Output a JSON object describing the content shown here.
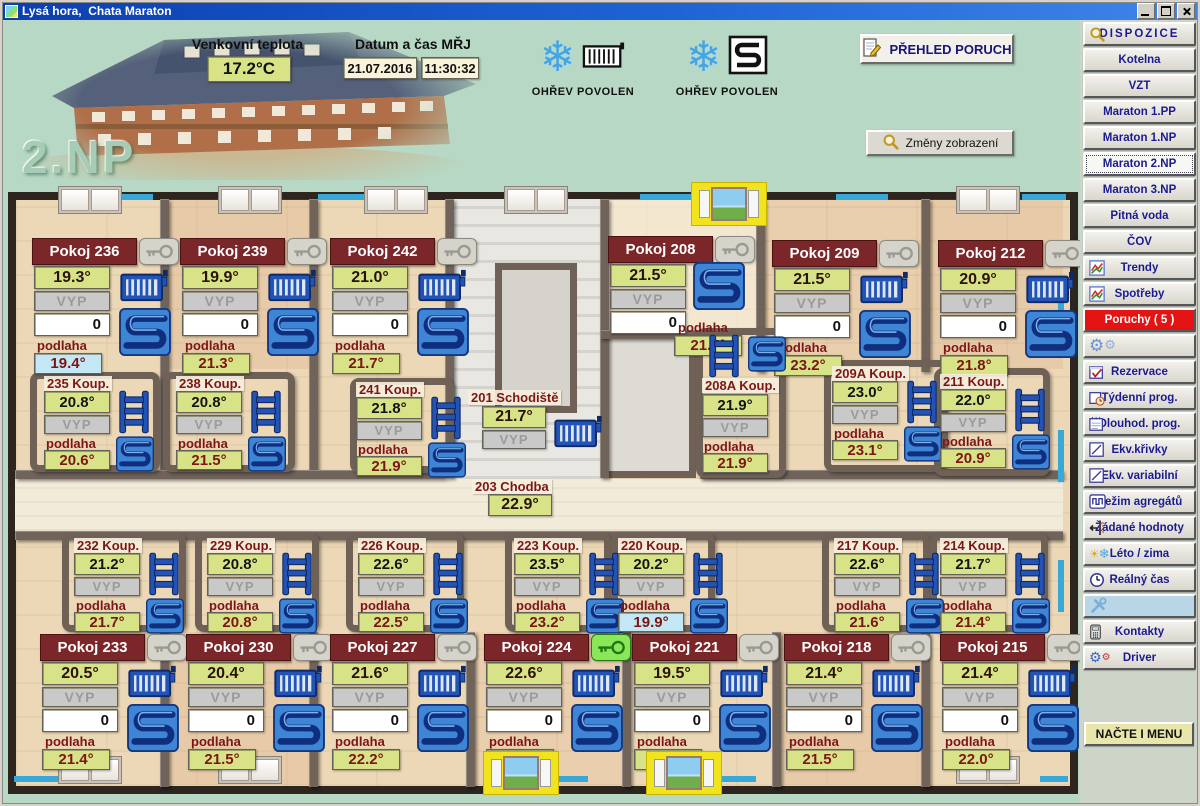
{
  "window": {
    "title": "Lysá hora,  Chata Maraton"
  },
  "header": {
    "floor_label": "2.NP",
    "outdoor": {
      "label": "Venkovní teplota",
      "value": "17.2°C"
    },
    "datetime": {
      "label": "Datum a čas MŘJ",
      "date": "21.07.2016",
      "time": "11:30:32"
    },
    "heat_radiators": {
      "label": "OHŘEV POVOLEN",
      "icons": [
        "snowflake",
        "radiator-outline"
      ]
    },
    "heat_floor": {
      "label": "OHŘEV POVOLEN",
      "icons": [
        "snowflake",
        "floor-coil-outline"
      ]
    },
    "faults_button": {
      "label": "PŘEHLED PORUCH",
      "icon": "report"
    },
    "view_button": {
      "label": "Změny zobrazení",
      "icon": "magnifier"
    }
  },
  "sidebar": {
    "items": [
      {
        "id": "dispozice",
        "label": "DISPOZICE",
        "icon": "magnifier",
        "spaced": true
      },
      {
        "id": "kotelna",
        "label": "Kotelna"
      },
      {
        "id": "vzt",
        "label": "VZT"
      },
      {
        "id": "maraton-1pp",
        "label": "Maraton 1.PP"
      },
      {
        "id": "maraton-1np",
        "label": "Maraton 1.NP"
      },
      {
        "id": "maraton-2np",
        "label": "Maraton 2.NP",
        "active": true
      },
      {
        "id": "maraton-3np",
        "label": "Maraton 3.NP"
      },
      {
        "id": "pitna-voda",
        "label": "Pitná voda"
      },
      {
        "id": "cov",
        "label": "ČOV"
      },
      {
        "id": "trendy",
        "label": "Trendy",
        "icon": "chart"
      },
      {
        "id": "spotreby",
        "label": "Spotřeby",
        "icon": "chart"
      },
      {
        "id": "poruchy",
        "label": "Poruchy ( 5 )",
        "alarm": true
      },
      {
        "id": "nastaveni",
        "label": "",
        "icon": "gears"
      },
      {
        "id": "rezervace",
        "label": "Rezervace",
        "icon": "cal-check"
      },
      {
        "id": "tydenni-prog",
        "label": "Týdenní prog.",
        "icon": "cal-clock"
      },
      {
        "id": "dlouhod-prog",
        "label": "Dlouhod. prog.",
        "icon": "cal"
      },
      {
        "id": "ekv-krivky",
        "label": "Ekv.křivky",
        "icon": "curve"
      },
      {
        "id": "ekv-variabilni",
        "label": "Ekv. variabilní",
        "icon": "curve"
      },
      {
        "id": "rezim-agregatu",
        "label": "Režim agregátů",
        "icon": "agregat"
      },
      {
        "id": "zadane-hodnoty",
        "label": "Žádané hodnoty",
        "icon": "slider"
      },
      {
        "id": "leto-zima",
        "label": "Léto / zima",
        "icon": "sun-snow"
      },
      {
        "id": "realny-cas",
        "label": "Reálný čas",
        "icon": "clock"
      },
      {
        "id": "servis",
        "label": "",
        "icon": "tools",
        "tool": true
      },
      {
        "id": "kontakty",
        "label": "Kontakty",
        "icon": "phone"
      },
      {
        "id": "driver",
        "label": "Driver",
        "icon": "driver"
      }
    ],
    "load_menu_button": "NAČTE I MENU"
  },
  "floorplan": {
    "podlaha_label": "podlaha",
    "rooms": [
      {
        "name": "Pokoj 236",
        "temp": "19.3°",
        "mode": "VYP",
        "setpoint": "0",
        "floor_temp": "19.4°",
        "floor_cold": true,
        "key": "grey",
        "equipment": [
          "radiator",
          "floor-coil"
        ]
      },
      {
        "name": "Pokoj 239",
        "temp": "19.9°",
        "mode": "VYP",
        "setpoint": "0",
        "floor_temp": "21.3°",
        "floor_cold": false,
        "key": "grey",
        "equipment": [
          "radiator",
          "floor-coil"
        ]
      },
      {
        "name": "Pokoj 242",
        "temp": "21.0°",
        "mode": "VYP",
        "setpoint": "0",
        "floor_temp": "21.7°",
        "floor_cold": false,
        "key": "grey",
        "equipment": [
          "radiator",
          "floor-coil"
        ]
      },
      {
        "name": "Pokoj 208",
        "temp": "21.5°",
        "mode": "VYP",
        "setpoint": "0",
        "floor_temp": "21.7°",
        "floor_cold": false,
        "key": "grey",
        "equipment": [
          "floor-coil"
        ]
      },
      {
        "name": "Pokoj 209",
        "temp": "21.5°",
        "mode": "VYP",
        "setpoint": "0",
        "floor_temp": "23.2°",
        "floor_cold": false,
        "key": "grey",
        "equipment": [
          "radiator",
          "floor-coil"
        ]
      },
      {
        "name": "Pokoj 212",
        "temp": "20.9°",
        "mode": "VYP",
        "setpoint": "0",
        "floor_temp": "21.8°",
        "floor_cold": false,
        "key": "grey",
        "equipment": [
          "radiator",
          "floor-coil"
        ]
      },
      {
        "name": "Pokoj 233",
        "temp": "20.5°",
        "mode": "VYP",
        "setpoint": "0",
        "floor_temp": "21.4°",
        "floor_cold": false,
        "key": "grey",
        "equipment": [
          "radiator",
          "floor-coil"
        ]
      },
      {
        "name": "Pokoj 230",
        "temp": "20.4°",
        "mode": "VYP",
        "setpoint": "0",
        "floor_temp": "21.5°",
        "floor_cold": false,
        "key": "grey",
        "equipment": [
          "radiator",
          "floor-coil"
        ]
      },
      {
        "name": "Pokoj 227",
        "temp": "21.6°",
        "mode": "VYP",
        "setpoint": "0",
        "floor_temp": "22.2°",
        "floor_cold": false,
        "key": "grey",
        "equipment": [
          "radiator",
          "floor-coil"
        ]
      },
      {
        "name": "Pokoj 224",
        "temp": "22.6°",
        "mode": "VYP",
        "setpoint": "0",
        "floor_temp": "22.5°",
        "floor_cold": false,
        "key": "green",
        "equipment": [
          "radiator",
          "floor-coil"
        ]
      },
      {
        "name": "Pokoj 221",
        "temp": "19.5°",
        "mode": "VYP",
        "setpoint": "0",
        "floor_temp": "20.2°",
        "floor_cold": false,
        "key": "grey",
        "equipment": [
          "radiator",
          "floor-coil"
        ]
      },
      {
        "name": "Pokoj 218",
        "temp": "21.4°",
        "mode": "VYP",
        "setpoint": "0",
        "floor_temp": "21.5°",
        "floor_cold": false,
        "key": "grey",
        "equipment": [
          "radiator",
          "floor-coil"
        ]
      },
      {
        "name": "Pokoj 215",
        "temp": "21.4°",
        "mode": "VYP",
        "setpoint": "0",
        "floor_temp": "22.0°",
        "floor_cold": false,
        "key": "grey",
        "equipment": [
          "radiator",
          "floor-coil"
        ]
      }
    ],
    "bathrooms": [
      {
        "name": "235 Koup.",
        "temp": "20.8°",
        "mode": "VYP",
        "floor_temp": "20.6°",
        "floor_cold": false,
        "equipment": [
          "towel-ladder",
          "floor-coil"
        ]
      },
      {
        "name": "238 Koup.",
        "temp": "20.8°",
        "mode": "VYP",
        "floor_temp": "21.5°",
        "floor_cold": false,
        "equipment": [
          "towel-ladder",
          "floor-coil"
        ]
      },
      {
        "name": "241 Koup.",
        "temp": "21.8°",
        "mode": "VYP",
        "floor_temp": "21.9°",
        "floor_cold": false,
        "equipment": [
          "towel-ladder",
          "floor-coil"
        ]
      },
      {
        "name": "208A Koup.",
        "temp": "21.9°",
        "mode": "VYP",
        "floor_temp": "21.9°",
        "floor_cold": false,
        "equipment": [
          "towel-ladder",
          "floor-coil"
        ]
      },
      {
        "name": "209A Koup.",
        "temp": "23.0°",
        "mode": "VYP",
        "floor_temp": "23.1°",
        "floor_cold": false,
        "equipment": [
          "towel-ladder",
          "floor-coil"
        ]
      },
      {
        "name": "211 Koup.",
        "temp": "22.0°",
        "mode": "VYP",
        "floor_temp": "20.9°",
        "floor_cold": false,
        "equipment": [
          "towel-ladder",
          "floor-coil"
        ]
      },
      {
        "name": "232 Koup.",
        "temp": "21.2°",
        "mode": "VYP",
        "floor_temp": "21.7°",
        "floor_cold": false,
        "equipment": [
          "towel-ladder",
          "floor-coil"
        ]
      },
      {
        "name": "229 Koup.",
        "temp": "20.8°",
        "mode": "VYP",
        "floor_temp": "20.8°",
        "floor_cold": false,
        "equipment": [
          "towel-ladder",
          "floor-coil"
        ]
      },
      {
        "name": "226 Koup.",
        "temp": "22.6°",
        "mode": "VYP",
        "floor_temp": "22.5°",
        "floor_cold": false,
        "equipment": [
          "towel-ladder",
          "floor-coil"
        ]
      },
      {
        "name": "223 Koup.",
        "temp": "23.5°",
        "mode": "VYP",
        "floor_temp": "23.2°",
        "floor_cold": false,
        "equipment": [
          "towel-ladder",
          "floor-coil"
        ]
      },
      {
        "name": "220 Koup.",
        "temp": "20.2°",
        "mode": "VYP",
        "floor_temp": "19.9°",
        "floor_cold": true,
        "equipment": [
          "towel-ladder",
          "floor-coil"
        ]
      },
      {
        "name": "217 Koup.",
        "temp": "22.6°",
        "mode": "VYP",
        "floor_temp": "21.6°",
        "floor_cold": false,
        "equipment": [
          "towel-ladder",
          "floor-coil"
        ]
      },
      {
        "name": "214 Koup.",
        "temp": "21.7°",
        "mode": "VYP",
        "floor_temp": "21.4°",
        "floor_cold": false,
        "equipment": [
          "towel-ladder",
          "floor-coil"
        ]
      }
    ],
    "staircase": {
      "name": "201 Schodiště",
      "temp": "21.7°",
      "mode": "VYP",
      "equipment": [
        "radiator"
      ]
    },
    "corridor": {
      "name": "203 Chodba",
      "temp": "22.9°"
    },
    "open_windows": [
      {
        "room": "Pokoj 209",
        "position": "top"
      },
      {
        "room": "Pokoj 224",
        "position": "bottom"
      },
      {
        "room": "Pokoj 221",
        "position": "bottom"
      }
    ]
  }
}
